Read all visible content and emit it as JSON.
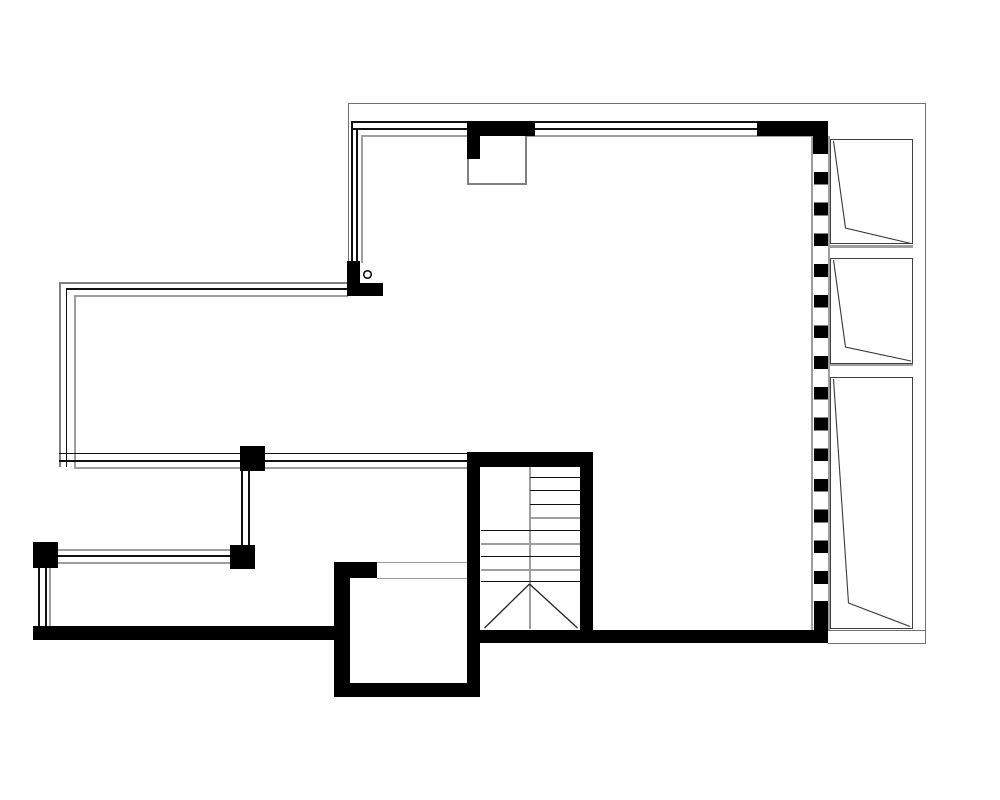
{
  "plan": {
    "type": "architectural floor plan",
    "view": "top-down black-and-white CAD line drawing",
    "aria_label": "Architectural floor plan line drawing with stairwell, glazed wings, wardrobe wall and balcony railings",
    "text_labels": []
  },
  "colors": {
    "background": "#ffffff",
    "wall": "#000000",
    "thin-line": "#111111",
    "gray-line": "#9e9e9e",
    "mid-gray": "#808080",
    "boundary": "#707070",
    "shelf-border": "#3f3f3f",
    "stroke": "#2f2f2f"
  },
  "features": {
    "glazed_window_bands": 3,
    "wardrobe_units": 3,
    "dashed_wall_blocks": 14,
    "stair_half_width_treads": 4,
    "stair_full_width_treads": 5,
    "columns": 6,
    "railing_runs": 3,
    "circle_markers": 1
  }
}
